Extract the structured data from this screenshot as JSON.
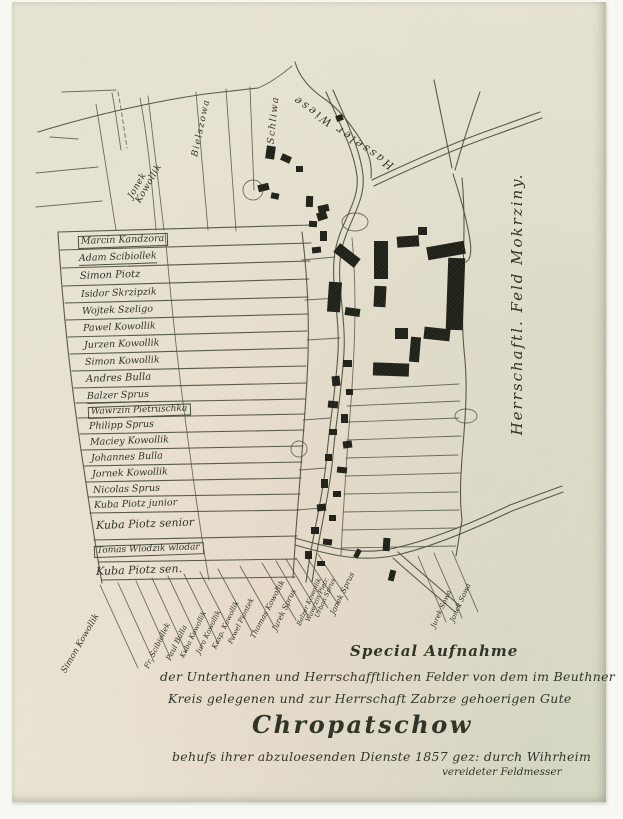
{
  "map_title": "Chropatschow",
  "caption": {
    "special": "Special Aufnahme",
    "line1": "der Unterthanen und Herrschafftlichen Felder von dem im Beuthner",
    "line2": "Kreis gelegenen und zur Herrschaft Zabrze gehoerigen Gute",
    "title": "Chropatschow",
    "line3": "behufs ihrer abzuloesenden Dienste 1857 gez: durch Wihrheim",
    "line4": "vereideter Feldmesser"
  },
  "colors": {
    "scan_bg": "#f7f8f3",
    "paper": "#e9e4d4",
    "ink": "#474c3a",
    "ink_dark": "#2c3025",
    "building": "#1e2017"
  },
  "area_labels": [
    {
      "text": "Jonek\nKowollik",
      "x": 134,
      "y": 180,
      "rot": -60,
      "size": 9,
      "ls": 0.5,
      "pre": true
    },
    {
      "text": "Bielszowa",
      "x": 190,
      "y": 126,
      "rot": -78,
      "size": 9,
      "ls": 1.5
    },
    {
      "text": "Schliwa",
      "x": 262,
      "y": 118,
      "rot": -84,
      "size": 9.5,
      "ls": 1.5
    },
    {
      "text": "Hasseler Wiese",
      "x": 331,
      "y": 130,
      "rot": 215,
      "size": 11,
      "ls": 2.5
    },
    {
      "text": "Herrschaftl. Feld Mokrziny.",
      "x": 506,
      "y": 302,
      "rot": -90,
      "size": 15,
      "ls": 2
    }
  ],
  "owners_left": [
    {
      "text": "Marcin Kandzora",
      "x": 66,
      "y": 234,
      "size": 9.5,
      "box": true
    },
    {
      "text": "Adam Scibiollek",
      "x": 67,
      "y": 252,
      "size": 9.5,
      "ul": true
    },
    {
      "text": "Simon Piotz",
      "x": 68,
      "y": 270,
      "size": 10
    },
    {
      "text": "Isidor Skrzipzik",
      "x": 69,
      "y": 288,
      "size": 9.5
    },
    {
      "text": "Wojtek Szeligo",
      "x": 70,
      "y": 305,
      "size": 9.5
    },
    {
      "text": "Pawel Kowollik",
      "x": 71,
      "y": 322,
      "size": 9.5
    },
    {
      "text": "Jurzen Kowollik",
      "x": 72,
      "y": 339,
      "size": 9.5
    },
    {
      "text": "Simon Kowollik",
      "x": 73,
      "y": 356,
      "size": 9.5
    },
    {
      "text": "Andres Bulla",
      "x": 74,
      "y": 373,
      "size": 10
    },
    {
      "text": "Balzer Sprus",
      "x": 75,
      "y": 390,
      "size": 9.5,
      "ul": true
    },
    {
      "text": "Wawrzin Pietruschka",
      "x": 76,
      "y": 405,
      "size": 9,
      "box": true
    },
    {
      "text": "Philipp Sprus",
      "x": 77,
      "y": 420,
      "size": 9.5
    },
    {
      "text": "Maciey Kowollik",
      "x": 78,
      "y": 436,
      "size": 9.5
    },
    {
      "text": "Johannes Bulla",
      "x": 79,
      "y": 452,
      "size": 9.5
    },
    {
      "text": "Jornek Kowollik",
      "x": 80,
      "y": 468,
      "size": 9.5
    },
    {
      "text": "Nicolas Sprus",
      "x": 81,
      "y": 484,
      "size": 9.5
    },
    {
      "text": "Kuba Piotz junior",
      "x": 82,
      "y": 499,
      "size": 9.5
    },
    {
      "text": "Kuba Piotz senior",
      "x": 84,
      "y": 518,
      "size": 11
    },
    {
      "text": "Tomas Wlodzik wlodar",
      "x": 82,
      "y": 544,
      "size": 9,
      "box": true
    },
    {
      "text": "Kuba Piotz sen.",
      "x": 84,
      "y": 564,
      "size": 11
    }
  ],
  "owners_bottom": [
    {
      "text": "Simon Kowollik",
      "x": 56,
      "y": 664,
      "rot": -60,
      "size": 8.5
    },
    {
      "text": "Fr. Scibiollek",
      "x": 138,
      "y": 660,
      "rot": -64,
      "size": 7.5
    },
    {
      "text": "Paul Bulla",
      "x": 160,
      "y": 652,
      "rot": -64,
      "size": 7.5
    },
    {
      "text": "Kuba Kowollik",
      "x": 174,
      "y": 650,
      "rot": -64,
      "size": 7
    },
    {
      "text": "Jura Kowollik",
      "x": 190,
      "y": 646,
      "rot": -64,
      "size": 7
    },
    {
      "text": "Kasp. Kowollik",
      "x": 206,
      "y": 641,
      "rot": -64,
      "size": 7
    },
    {
      "text": "Pawel Piontek",
      "x": 222,
      "y": 636,
      "rot": -64,
      "size": 7
    },
    {
      "text": "Thomas Kowollik",
      "x": 244,
      "y": 630,
      "rot": -62,
      "size": 7.5
    },
    {
      "text": "Jurek Sprus",
      "x": 266,
      "y": 622,
      "rot": -64,
      "size": 7.5
    },
    {
      "text": "Balzer Kowollik",
      "x": 290,
      "y": 618,
      "rot": -66,
      "size": 6.5
    },
    {
      "text": "Wawrzin Pietr.",
      "x": 299,
      "y": 614,
      "rot": -66,
      "size": 6.5
    },
    {
      "text": "Urban Sprus",
      "x": 308,
      "y": 610,
      "rot": -66,
      "size": 6.5
    },
    {
      "text": "Jonek Sprus",
      "x": 324,
      "y": 606,
      "rot": -64,
      "size": 7.5
    },
    {
      "text": "Jurek Sowa",
      "x": 425,
      "y": 620,
      "rot": -66,
      "size": 7
    },
    {
      "text": "Jonek Sowa",
      "x": 444,
      "y": 614,
      "rot": -66,
      "size": 7
    }
  ],
  "houses": [
    {
      "x": 266,
      "y": 146,
      "w": 9,
      "h": 13,
      "r": 8
    },
    {
      "x": 281,
      "y": 155,
      "w": 10,
      "h": 7,
      "r": 24
    },
    {
      "x": 296,
      "y": 166,
      "w": 7,
      "h": 6,
      "r": 0
    },
    {
      "x": 336,
      "y": 115,
      "w": 7,
      "h": 6,
      "r": -20
    },
    {
      "x": 258,
      "y": 184,
      "w": 11,
      "h": 7,
      "r": -14
    },
    {
      "x": 271,
      "y": 193,
      "w": 8,
      "h": 6,
      "r": 12
    },
    {
      "x": 306,
      "y": 196,
      "w": 7,
      "h": 11,
      "r": 2
    },
    {
      "x": 318,
      "y": 205,
      "w": 11,
      "h": 7,
      "r": -12
    },
    {
      "x": 309,
      "y": 221,
      "w": 8,
      "h": 6,
      "r": 4
    },
    {
      "x": 320,
      "y": 231,
      "w": 7,
      "h": 10,
      "r": 0
    },
    {
      "x": 312,
      "y": 247,
      "w": 9,
      "h": 6,
      "r": -6
    },
    {
      "x": 317,
      "y": 212,
      "w": 10,
      "h": 8,
      "r": -18
    },
    {
      "x": 334,
      "y": 250,
      "w": 26,
      "h": 11,
      "r": 38
    },
    {
      "x": 328,
      "y": 282,
      "w": 13,
      "h": 30,
      "r": 4
    },
    {
      "x": 345,
      "y": 308,
      "w": 15,
      "h": 8,
      "r": 8
    },
    {
      "x": 374,
      "y": 241,
      "w": 14,
      "h": 38,
      "r": 0
    },
    {
      "x": 397,
      "y": 236,
      "w": 22,
      "h": 11,
      "r": -4
    },
    {
      "x": 418,
      "y": 227,
      "w": 9,
      "h": 8,
      "r": 0
    },
    {
      "x": 374,
      "y": 286,
      "w": 12,
      "h": 21,
      "r": 3
    },
    {
      "x": 395,
      "y": 328,
      "w": 13,
      "h": 11,
      "r": 0
    },
    {
      "x": 410,
      "y": 337,
      "w": 10,
      "h": 25,
      "r": 5
    },
    {
      "x": 373,
      "y": 363,
      "w": 36,
      "h": 13,
      "r": 2
    },
    {
      "x": 427,
      "y": 244,
      "w": 38,
      "h": 13,
      "r": -10
    },
    {
      "x": 447,
      "y": 258,
      "w": 17,
      "h": 72,
      "r": 2
    },
    {
      "x": 424,
      "y": 328,
      "w": 26,
      "h": 12,
      "r": 6
    },
    {
      "x": 343,
      "y": 360,
      "w": 9,
      "h": 7,
      "r": 0
    },
    {
      "x": 332,
      "y": 376,
      "w": 8,
      "h": 10,
      "r": -6
    },
    {
      "x": 346,
      "y": 389,
      "w": 7,
      "h": 6,
      "r": 0
    },
    {
      "x": 328,
      "y": 401,
      "w": 10,
      "h": 7,
      "r": 6
    },
    {
      "x": 341,
      "y": 414,
      "w": 7,
      "h": 9,
      "r": 0
    },
    {
      "x": 329,
      "y": 429,
      "w": 8,
      "h": 6,
      "r": 0
    },
    {
      "x": 343,
      "y": 441,
      "w": 9,
      "h": 7,
      "r": -8
    },
    {
      "x": 325,
      "y": 454,
      "w": 7,
      "h": 7,
      "r": 0
    },
    {
      "x": 337,
      "y": 467,
      "w": 10,
      "h": 6,
      "r": 6
    },
    {
      "x": 321,
      "y": 479,
      "w": 7,
      "h": 9,
      "r": 0
    },
    {
      "x": 333,
      "y": 491,
      "w": 8,
      "h": 6,
      "r": 0
    },
    {
      "x": 317,
      "y": 504,
      "w": 9,
      "h": 7,
      "r": -6
    },
    {
      "x": 329,
      "y": 515,
      "w": 7,
      "h": 6,
      "r": 0
    },
    {
      "x": 311,
      "y": 527,
      "w": 8,
      "h": 7,
      "r": 0
    },
    {
      "x": 323,
      "y": 539,
      "w": 9,
      "h": 6,
      "r": 6
    },
    {
      "x": 305,
      "y": 551,
      "w": 7,
      "h": 8,
      "r": 0
    },
    {
      "x": 317,
      "y": 561,
      "w": 8,
      "h": 5,
      "r": 0
    },
    {
      "x": 383,
      "y": 538,
      "w": 7,
      "h": 13,
      "r": 4
    },
    {
      "x": 355,
      "y": 549,
      "w": 5,
      "h": 9,
      "r": 28
    },
    {
      "x": 389,
      "y": 570,
      "w": 6,
      "h": 11,
      "r": 14
    }
  ]
}
